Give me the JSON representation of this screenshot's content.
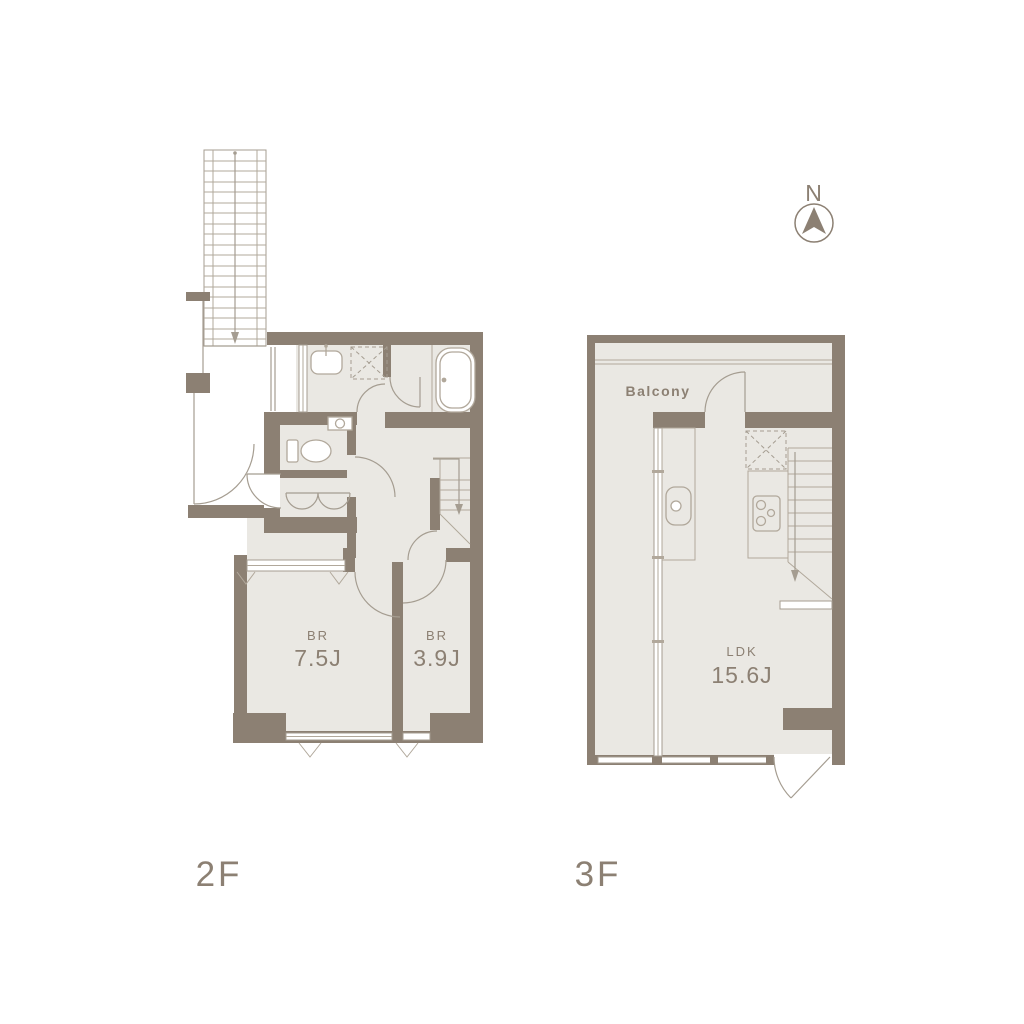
{
  "compass": {
    "label": "N"
  },
  "floors": [
    {
      "label": "2F",
      "rooms": [
        {
          "type": "bedroom",
          "label": "BR",
          "size": "7.5J"
        },
        {
          "type": "bedroom",
          "label": "BR",
          "size": "3.9J"
        }
      ],
      "fixtures": [
        "exterior-stairs",
        "entrance-door",
        "washbasin",
        "washing-machine-space",
        "bathtub",
        "toilet",
        "closet-folding-doors",
        "interior-stairs",
        "windows"
      ]
    },
    {
      "label": "3F",
      "balcony_label": "Balcony",
      "rooms": [
        {
          "type": "living-dining-kitchen",
          "label": "LDK",
          "size": "15.6J"
        }
      ],
      "fixtures": [
        "balcony-rail",
        "kitchen-sink",
        "gas-stove",
        "refrigerator-space",
        "interior-stairs",
        "windows",
        "terrace-door"
      ]
    }
  ],
  "colors": {
    "background": "#ffffff",
    "wall": "#8c8073",
    "floor": "#eae8e3",
    "line": "#a59d91",
    "fixture_line": "#b1a89b",
    "text": "#8c8073"
  }
}
